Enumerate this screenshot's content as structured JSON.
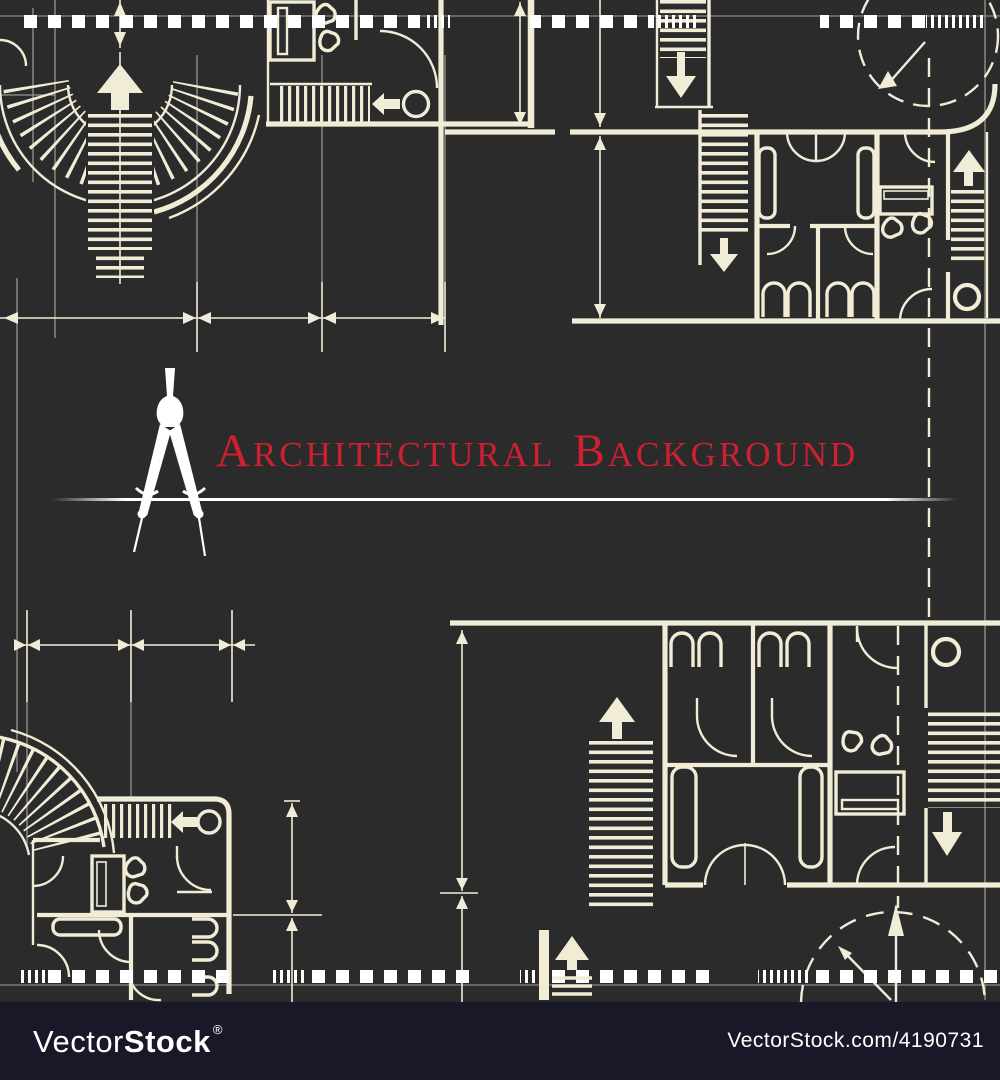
{
  "colors": {
    "background": "#2C2B2B",
    "line": "#F0ECD6",
    "white": "#FFFFFF",
    "title_red": "#CE2030",
    "bar_bg": "#191828",
    "bar_text": "#FFFFFF"
  },
  "title": {
    "full": "ARCHITECTURAL BACKGROUND",
    "word1": "ARCHITECTURAL",
    "word2": "BACKGROUND"
  },
  "watermark": {
    "brand_light": "Vector",
    "brand_bold": "Stock",
    "registered": "®",
    "site_ref": "VectorStock.com/4190731"
  }
}
